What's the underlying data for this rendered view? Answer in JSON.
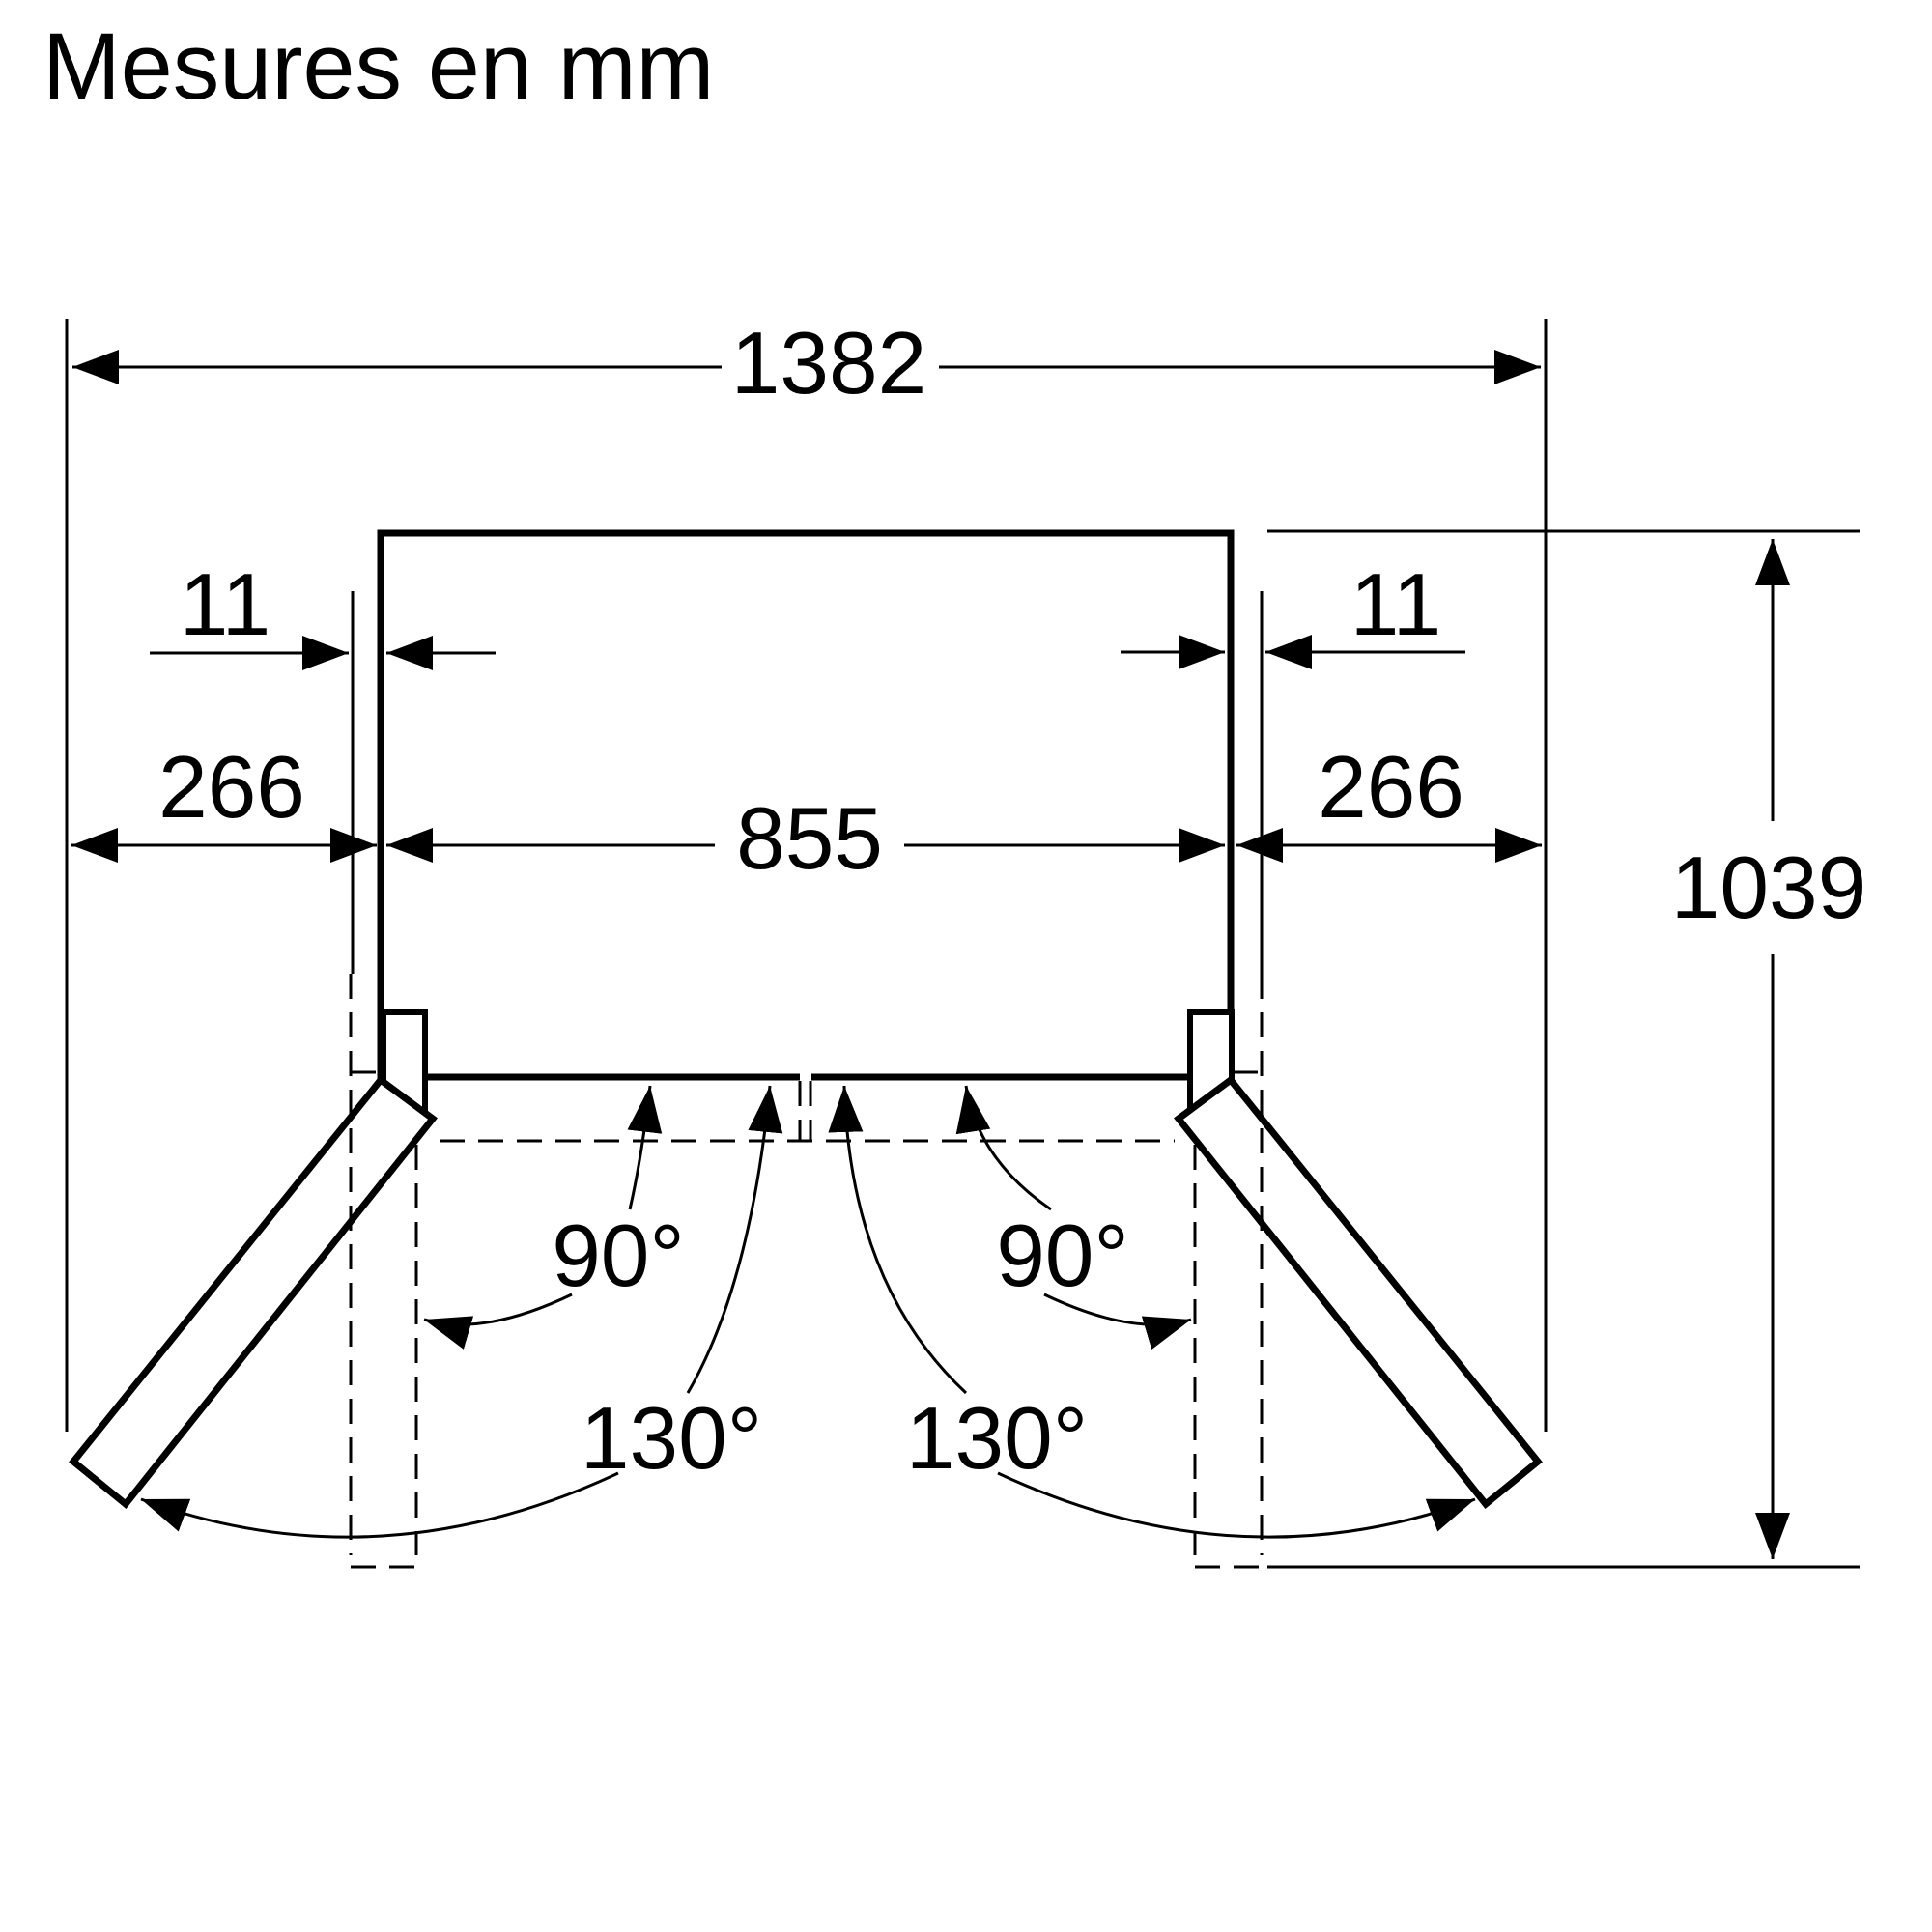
{
  "title": "Mesures en mm",
  "dimensions": {
    "total_width": "1382",
    "body_width": "855",
    "side_clearance_left": "266",
    "side_clearance_right": "266",
    "door_protrusion_left": "11",
    "door_protrusion_right": "11",
    "total_depth": "1039"
  },
  "angles": {
    "left_90": "90°",
    "right_90": "90°",
    "left_130": "130°",
    "right_130": "130°"
  },
  "colors": {
    "line": "#000000",
    "background": "#ffffff"
  }
}
